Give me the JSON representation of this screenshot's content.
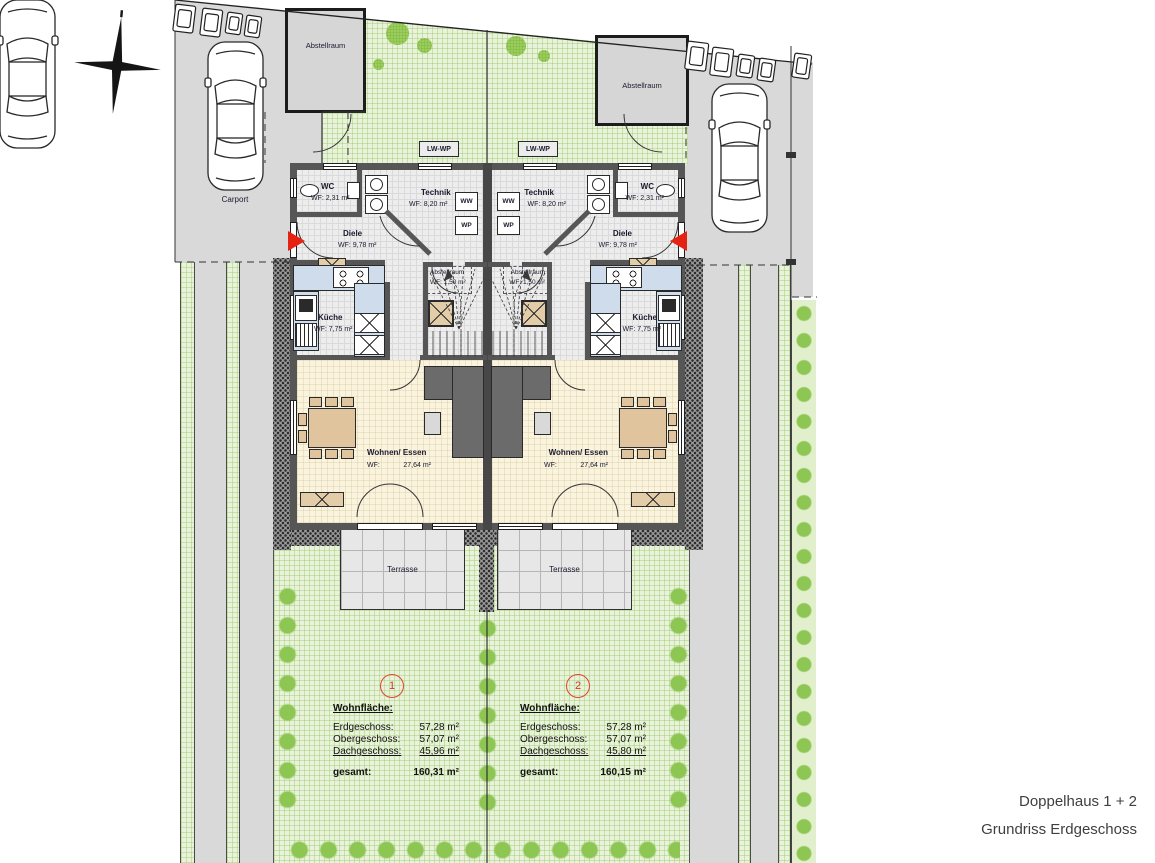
{
  "footer": {
    "line1": "Doppelhaus 1 + 2",
    "line2": "Grundriss Erdgeschoss"
  },
  "site": {
    "carport_left": "Carport",
    "carport_right": "Carport",
    "shed_left": "Abstellraum",
    "shed_right": "Abstellraum",
    "heat_pump_left": "LW-WP",
    "heat_pump_right": "LW-WP"
  },
  "units": [
    {
      "number": "1",
      "rooms": {
        "wc_name": "WC",
        "wc_area": "WF: 2,31 m²",
        "technik_name": "Technik",
        "technik_area": "WF: 8,20 m²",
        "ww": "WW",
        "wp": "WP",
        "diele_name": "Diele",
        "diele_area": "WF: 9,78 m²",
        "store_name": "Abstellraum",
        "store_area": "WF: 1,50 m²",
        "kitchen_name": "Küche",
        "kitchen_area": "WF: 7,75 m²",
        "living_name": "Wohnen/ Essen",
        "living_area_label": "WF:",
        "living_area_value": "27,64 m²",
        "terrace": "Terrasse"
      },
      "areas": {
        "heading": "Wohnfläche:",
        "rows": [
          {
            "label": "Erdgeschoss:",
            "value": "57,28 m²"
          },
          {
            "label": "Obergeschoss:",
            "value": "57,07 m²"
          },
          {
            "label": "Dachgeschoss:",
            "value": "45,96 m²"
          }
        ],
        "total_label": "gesamt:",
        "total_value": "160,31 m²"
      }
    },
    {
      "number": "2",
      "rooms": {
        "wc_name": "WC",
        "wc_area": "WF: 2,31 m²",
        "technik_name": "Technik",
        "technik_area": "WF: 8,20 m²",
        "ww": "WW",
        "wp": "WP",
        "diele_name": "Diele",
        "diele_area": "WF: 9,78 m²",
        "store_name": "Abstellraum",
        "store_area": "WF: 1,50 m²",
        "kitchen_name": "Küche",
        "kitchen_area": "WF: 7,75 m²",
        "living_name": "Wohnen/ Essen",
        "living_area_label": "WF:",
        "living_area_value": "27,64 m²",
        "terrace": "Terrasse"
      },
      "areas": {
        "heading": "Wohnfläche:",
        "rows": [
          {
            "label": "Erdgeschoss:",
            "value": "57,28 m²"
          },
          {
            "label": "Obergeschoss:",
            "value": "57,07 m²"
          },
          {
            "label": "Dachgeschoss:",
            "value": "45,80 m²"
          }
        ],
        "total_label": "gesamt:",
        "total_value": "160,15 m²"
      }
    }
  ],
  "colors": {
    "accent_red": "#e42313",
    "garden_green": "#e9f2da",
    "bush_green": "#8dc653",
    "driveway_gray": "#d9d9d9",
    "wall_gray": "#565656",
    "living_floor": "#faf3de",
    "kitchen_counter": "#cfdcec"
  }
}
